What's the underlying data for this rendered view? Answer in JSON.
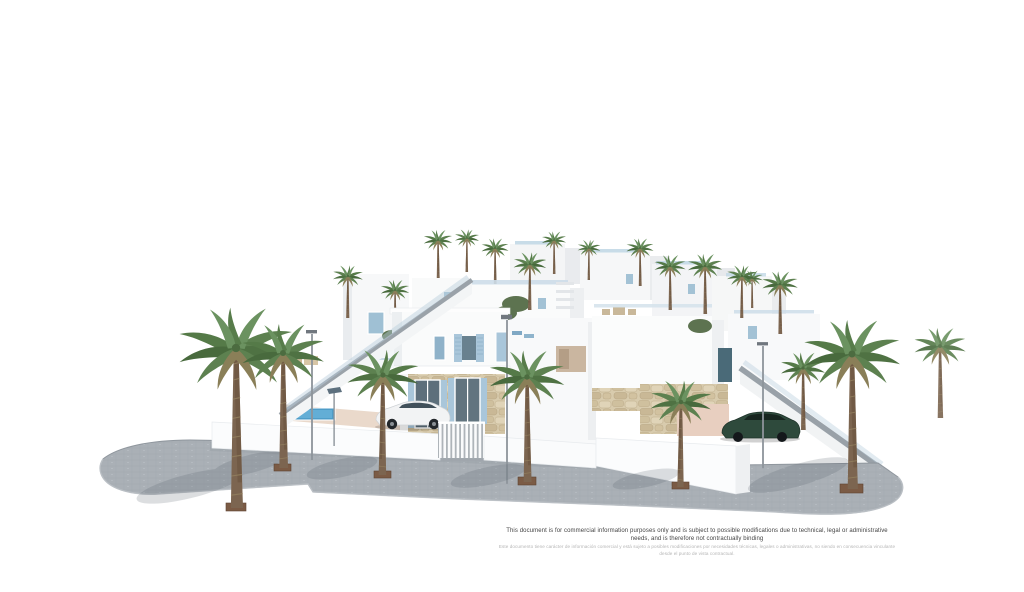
{
  "disclaimer": {
    "line1_en": "This document is for commercial information purposes only and is subject to possible modifications due to technical, legal or administrative needs, and is therefore not contractually binding",
    "line2_es": "Este documento tiene carácter de información comercial y está sujeto a posibles modificaciones por necesidades técnicas, legales o administrativas, no siendo en consecuencia vinculante desde el punto de vista contractual."
  },
  "scene": {
    "alt": "3D architectural render of a row of white Mediterranean villas with blue shutters, stone-clad ground floors, palm trees and a grey paved street corner",
    "palette": {
      "background": "#ffffff",
      "sidewalk_gray": "#aab0b6",
      "curb_gray": "#9aa1a8",
      "wall_white": "#fafbfc",
      "facade_shadow": "#e9ecef",
      "shutter_blue": "#a9c6da",
      "glass_dark": "#5d6f7b",
      "stone_beige": "#d8cbad",
      "terrace_pink": "#ead9cb",
      "pool_blue": "#63aed6",
      "palm_green": "#5d8150",
      "palm_trunk": "#7c6550",
      "car_white": "#f2f3f4",
      "car_green": "#2e4a3c",
      "planter_brown": "#7b5b45",
      "disclaimer_dark": "#434343",
      "disclaimer_light": "#b5b5b5"
    }
  }
}
